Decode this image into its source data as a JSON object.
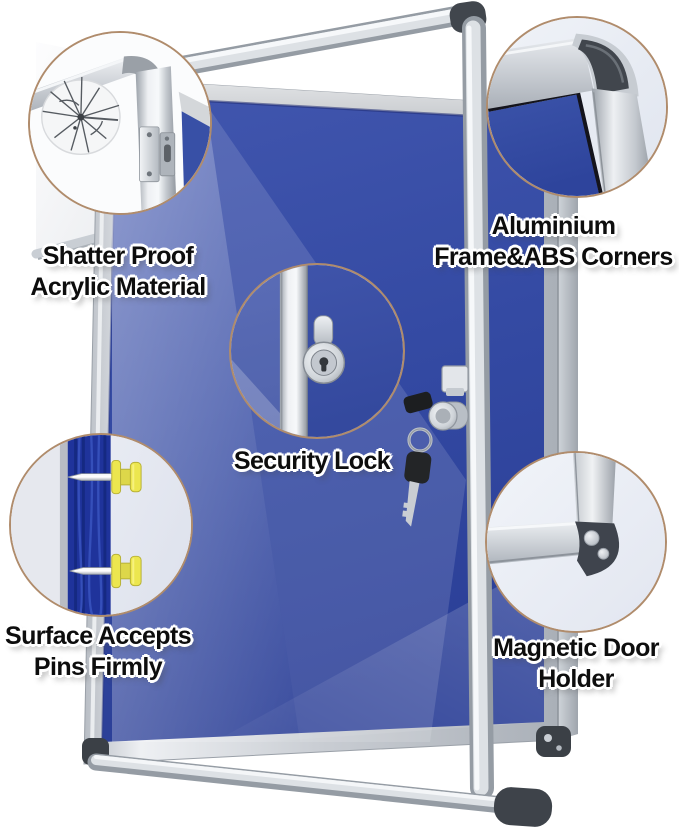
{
  "callouts": [
    {
      "label": "Shatter Proof\nAcrylic Material",
      "icon": "cracked-acrylic-icon"
    },
    {
      "label": "Aluminium\nFrame&ABS Corners",
      "icon": "frame-corner-icon"
    },
    {
      "label": "Security Lock",
      "icon": "lock-cylinder-icon"
    },
    {
      "label": "Surface Accepts\nPins Firmly",
      "icon": "push-pins-icon"
    },
    {
      "label": "Magnetic Door\nHolder",
      "icon": "magnet-corner-icon"
    }
  ],
  "colors": {
    "felt_blue": "#3750a6",
    "felt_blue_dark": "#2b3f97",
    "navy_cross_section": "#1f339b",
    "frame_silver": "#d7dade",
    "abs_corner_dark": "#41464d",
    "callout_ring_tan": "#b08c6c",
    "pin_yellow": "#ece64f",
    "label_text": "#0d0d0d",
    "label_outline": "#ffffff"
  }
}
